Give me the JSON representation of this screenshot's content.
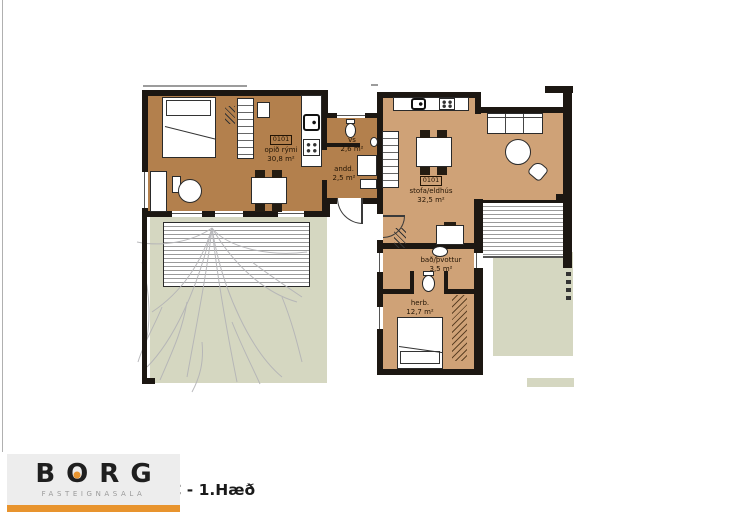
{
  "plan": {
    "rooms": [
      {
        "unit": "0101",
        "label": "opið rými",
        "area": "30,8 m²"
      },
      {
        "label": "vs",
        "area": "2,6 m²"
      },
      {
        "label": "andd.",
        "area": "2,5 m²"
      },
      {
        "unit": "0101",
        "label": "stofa/eldhús",
        "area": "32,5 m²"
      },
      {
        "label": "bað/þvottur",
        "area": "3,5 m²"
      },
      {
        "label": "herb.",
        "area": "12,7 m²"
      }
    ],
    "colors": {
      "floor_dark": "#b3804d",
      "floor_light": "#cfa277",
      "garden": "#d5d7c1",
      "wall": "#1c1712",
      "accent_orange": "#e8942e"
    },
    "icons": {
      "stove-icon": "2x2 burner dots",
      "sink-icon": "rounded basin with tap dot",
      "toilet-icon": "oval bowl with tank",
      "tree-icon": "gray branch lines",
      "door-arc-icon": "quarter-circle swing"
    }
  },
  "footer": {
    "logo_letters": [
      "B",
      "O",
      "R",
      "G"
    ],
    "logo_subtitle": "FASTEIGNASALA",
    "caption": "C - 1.Hæð"
  }
}
